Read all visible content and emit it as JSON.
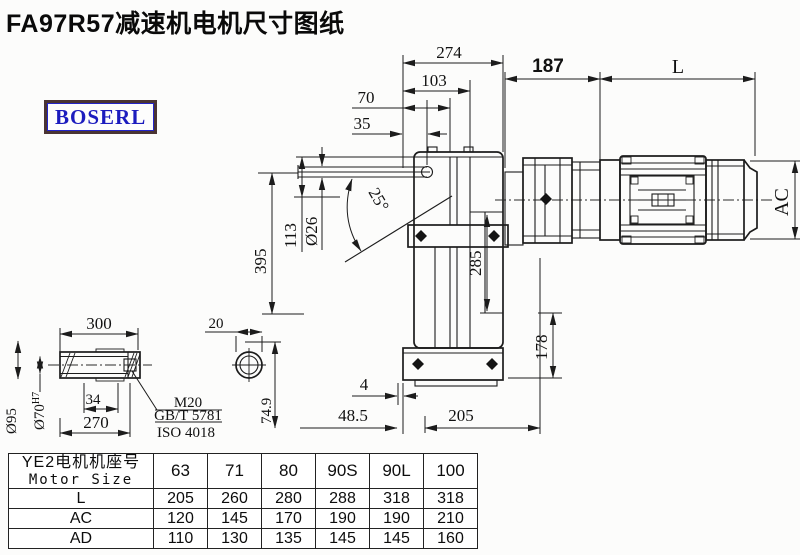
{
  "title": "FA97R57减速机电机尺寸图纸",
  "brand": "BOSERL",
  "drawing": {
    "dims": {
      "d274": "274",
      "d103": "103",
      "d70": "70",
      "d35": "35",
      "d187": "187",
      "dL": "L",
      "dAC": "AC",
      "d395": "395",
      "d113": "113",
      "d26": "Ø26",
      "d25": "25°",
      "d285": "285",
      "d178": "178",
      "d4": "4",
      "d485": "48.5",
      "d205": "205",
      "d300": "300",
      "d34": "34",
      "d270": "270",
      "d95": "Ø95",
      "d70b": "Ø70",
      "d70sup": "H7",
      "dM20": "M20",
      "dGBT": "GB/T 5781",
      "dISO": "ISO 4018",
      "d20": "20",
      "d749": "74.9"
    }
  },
  "table": {
    "header_cn": "YE2电机机座号",
    "header_en": "Motor Size",
    "sizes": [
      "63",
      "71",
      "80",
      "90S",
      "90L",
      "100"
    ],
    "rows": [
      {
        "label": "L",
        "values": [
          "205",
          "260",
          "280",
          "288",
          "318",
          "318"
        ]
      },
      {
        "label": "AC",
        "values": [
          "120",
          "145",
          "170",
          "190",
          "190",
          "210"
        ]
      },
      {
        "label": "AD",
        "values": [
          "110",
          "130",
          "135",
          "145",
          "145",
          "160"
        ]
      }
    ]
  }
}
